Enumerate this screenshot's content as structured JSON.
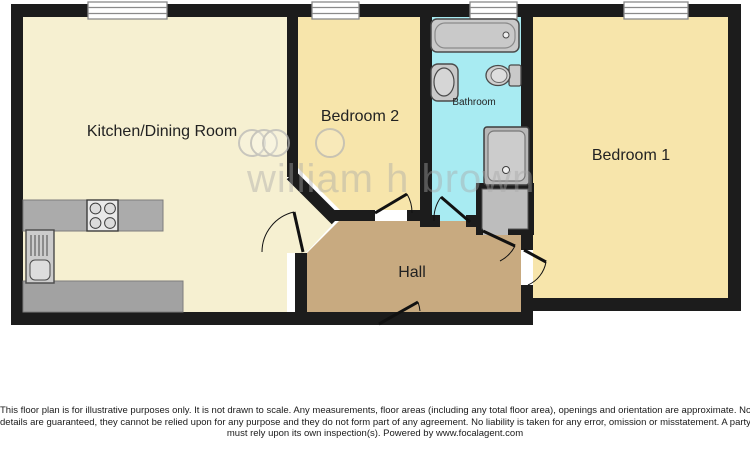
{
  "floorplan": {
    "wall_color": "#1c1c1c",
    "rooms": [
      {
        "id": "kitchen",
        "label": "Kitchen/Dining Room",
        "color": "#f6f0d1"
      },
      {
        "id": "bedroom2",
        "label": "Bedroom 2",
        "color": "#f7e5ab"
      },
      {
        "id": "bathroom",
        "label": "Bathroom",
        "color": "#a8ebf2"
      },
      {
        "id": "bedroom1",
        "label": "Bedroom 1",
        "color": "#f7e5ab"
      },
      {
        "id": "hall",
        "label": "Hall",
        "color": "#c8aa80"
      }
    ],
    "fixtures": [
      "bathtub",
      "wash-basin",
      "toilet",
      "shower",
      "hob",
      "kitchen-sink",
      "worktop",
      "storage-cupboard"
    ],
    "window_count": 4,
    "door_count": 6,
    "fixture_color": "#c9c9c9",
    "counter_color": "#ababab"
  },
  "watermark": {
    "text": "william h brown"
  },
  "disclaimer": {
    "lines": [
      "This floor plan is for illustrative purposes only. It is not drawn to scale. Any measurements, floor areas (including any total floor area), openings and orientation are approximate. No",
      "details are guaranteed, they cannot be relied upon for any purpose and they do not form part of any agreement. No liability is taken for any error, omission or misstatement. A party",
      "must rely upon its own inspection(s). Powered by www.focalagent.com"
    ]
  }
}
